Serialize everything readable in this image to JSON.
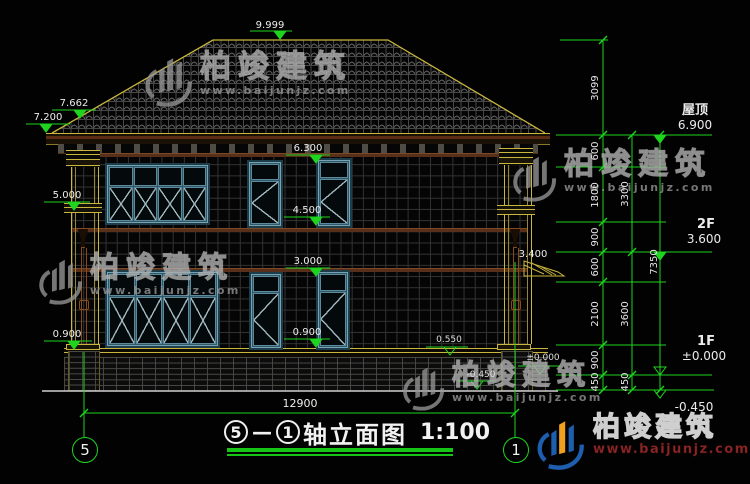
{
  "brand": {
    "name": "柏竣建筑",
    "url": "www.baijunjz.com"
  },
  "title": {
    "circle_left": "5",
    "dash": "—",
    "circle_right": "1",
    "name": "轴立面图",
    "scale": "1:100"
  },
  "axes": {
    "left": "5",
    "right": "1"
  },
  "levels": {
    "ridge": "9.999",
    "eave_upper": "7.662",
    "eave": "7.200",
    "pilaster_band": "5.000",
    "left_sill": "0.900",
    "f2_win_top": "6.300",
    "f2_win_sill": "4.500",
    "f1_win_top": "3.000",
    "f1_win_sill": "0.900",
    "awning": "3.400",
    "step": "0.550",
    "ground_zero": "±0.000",
    "ground_minus": "-0.450"
  },
  "right_panel": {
    "roof_label": "屋顶",
    "roof_level": "6.900",
    "f2_label": "2F",
    "f2_level": "3.600",
    "f1_label": "1F",
    "f1_level": "±0.000",
    "base_level": "-0.450",
    "dims_inner": [
      "3099",
      "600",
      "1800",
      "900",
      "600",
      "2100",
      "900",
      "450"
    ],
    "dims_middle": [
      "3300",
      "3600",
      "450"
    ],
    "dim_total": "7350"
  },
  "bottom": {
    "width_dim": "12900"
  },
  "colors": {
    "accent_green": "#1fd41f",
    "cad_yellow": "#c9b63c",
    "window_frame_blue": "#2e5868",
    "watermark_gray": "#969696",
    "logo_blue": "#1d5fae",
    "logo_orange": "#f0a01e",
    "url_red": "#8c2626"
  }
}
